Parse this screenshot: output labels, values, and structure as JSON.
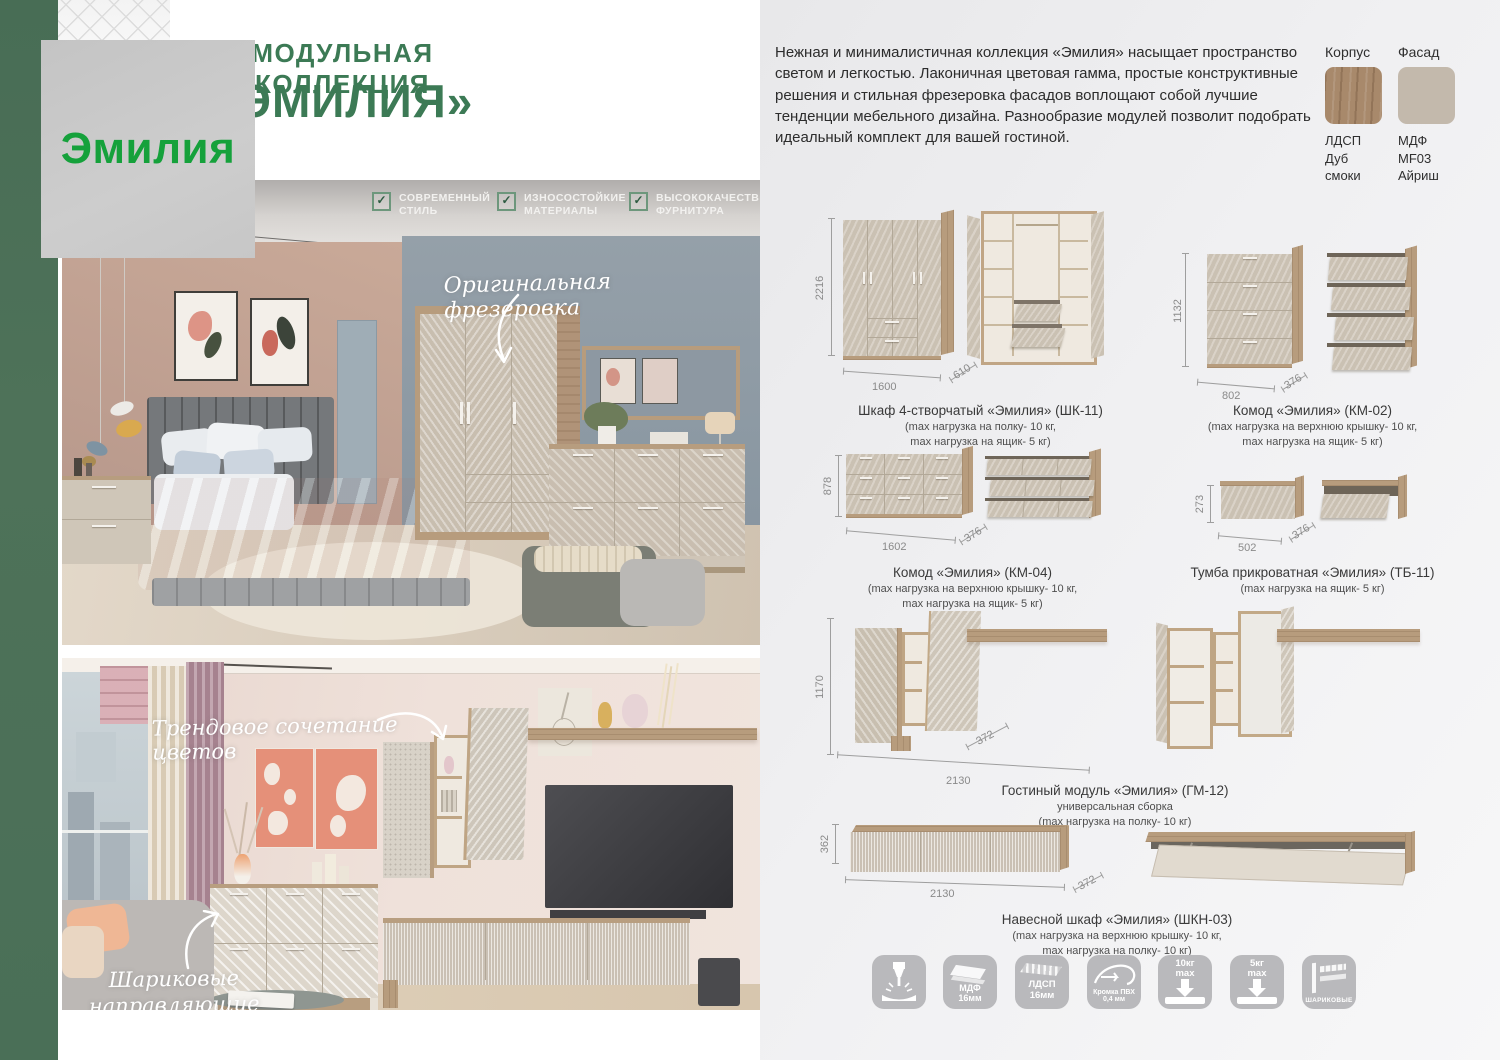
{
  "logo": "Эмилия",
  "header": {
    "line1": "МОДУЛЬНАЯ КОЛЛЕКЦИЯ",
    "line2": "«ЭМИЛИЯ»"
  },
  "features": [
    {
      "label": "СОВРЕМЕННЫЙ\nСТИЛЬ"
    },
    {
      "label": "ИЗНОСОСТОЙКИЕ\nМАТЕРИАЛЫ"
    },
    {
      "label": "ВЫСОКОКАЧЕСТВЕ\nФУРНИТУРА"
    }
  ],
  "photo_annotations": {
    "bedroom": "Оригинальная фрезеровка",
    "livingroom_top": "Трендовое сочетание цветов",
    "livingroom_bottom": "Шариковые\nнаправляющие"
  },
  "description": "Нежная и минималистичная коллекция «Эмилия» насыщает пространство светом и легкостью. Лаконичная цветовая гамма, простые конструктивные решения и стильная фрезеровка фасадов воплощают собой лучшие тенденции мебельного дизайна. Разнообразие модулей позволит подобрать идеальный комплект для вашей гостиной.",
  "materials": {
    "korpus": {
      "label": "Корпус",
      "caption": "ЛДСП\nДуб\nсмоки",
      "color": "#a8896b"
    },
    "fasad": {
      "label": "Фасад",
      "caption": "МДФ\nMF03\nАйриш",
      "color": "#c3b9ac"
    }
  },
  "products": [
    {
      "name": "Шкаф 4-створчатый «Эмилия» (ШК-11)",
      "note": "(max нагрузка на полку- 10 кг,\nmax нагрузка на ящик- 5 кг)",
      "height": "2216",
      "width": "1600",
      "depth": "610"
    },
    {
      "name": "Комод «Эмилия» (КМ-02)",
      "note": "(max нагрузка на верхнюю крышку- 10 кг,\nmax нагрузка на ящик- 5 кг)",
      "height": "1132",
      "width": "802",
      "depth": "376"
    },
    {
      "name": "Комод «Эмилия» (КМ-04)",
      "note": "(max нагрузка на верхнюю крышку- 10 кг,\nmax нагрузка на ящик- 5 кг)",
      "height": "878",
      "width": "1602",
      "depth": "376"
    },
    {
      "name": "Тумба прикроватная «Эмилия» (ТБ-11)",
      "note": "(max нагрузка на ящик- 5 кг)",
      "height": "273",
      "width": "502",
      "depth": "376"
    },
    {
      "name": "Гостиный модуль «Эмилия» (ГМ-12)",
      "note": "универсальная сборка\n(max нагрузка на полку- 10 кг)",
      "height": "1170",
      "width": "2130",
      "depth": "372"
    },
    {
      "name": "Навесной шкаф «Эмилия» (ШКН-03)",
      "note": "(max нагрузка на верхнюю крышку- 10 кг,\nmax нагрузка на полку- 10 кг)",
      "height": "362",
      "width": "2130",
      "depth": "372"
    }
  ],
  "badges": [
    {
      "name": "milling",
      "label": ""
    },
    {
      "name": "mdf-16",
      "label": "МДФ\n16мм"
    },
    {
      "name": "ldsp-16",
      "label": "ЛДСП\n16мм"
    },
    {
      "name": "edge-pvc",
      "label": "Кромка ПВХ\n0,4 мм"
    },
    {
      "name": "load-10",
      "label": "10кг\nmax"
    },
    {
      "name": "load-5",
      "label": "5кг\nmax"
    },
    {
      "name": "ball-slides",
      "label": "ШАРИКОВЫЕ"
    }
  ],
  "colors": {
    "accent_green_dark": "#3c7a55",
    "accent_green_bright": "#15a13b",
    "strip_green": "#4c7158"
  }
}
